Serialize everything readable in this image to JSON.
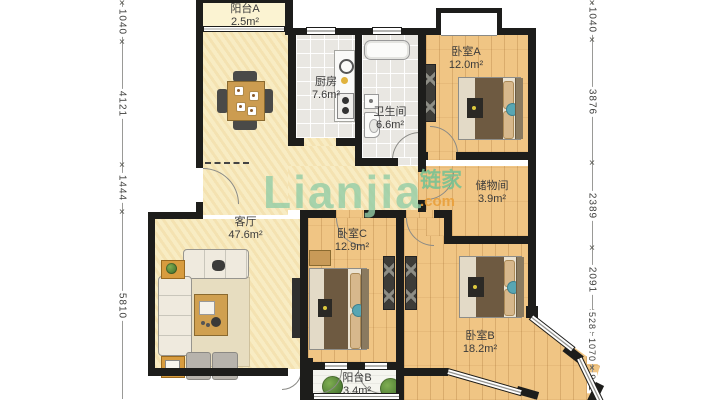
{
  "plan": {
    "rooms": [
      {
        "key": "balcony_a",
        "name": "阳台A",
        "area": "2.5m²"
      },
      {
        "key": "kitchen",
        "name": "厨房",
        "area": "7.6m²"
      },
      {
        "key": "bathroom",
        "name": "卫生间",
        "area": "6.6m²"
      },
      {
        "key": "bedroom_a",
        "name": "卧室A",
        "area": "12.0m²"
      },
      {
        "key": "storage",
        "name": "储物间",
        "area": "3.9m²"
      },
      {
        "key": "living",
        "name": "客厅",
        "area": "47.6m²"
      },
      {
        "key": "bedroom_c",
        "name": "卧室C",
        "area": "12.9m²"
      },
      {
        "key": "bedroom_b",
        "name": "卧室B",
        "area": "18.2m²"
      },
      {
        "key": "balcony_b",
        "name": "阳台B",
        "area": "3.4m²"
      }
    ],
    "dimensions": {
      "left": [
        "1040",
        "4121",
        "1444",
        "5810"
      ],
      "right": [
        "1040",
        "3876",
        "2389",
        "2091",
        "528",
        "1070",
        "911"
      ]
    },
    "dim_tick": "✕",
    "watermark": {
      "latin": "Lianjia",
      "cn": "链家",
      "tld": ".com"
    },
    "colors": {
      "wall": "#1d1d1b",
      "living_floor": "#f8ecc3",
      "wood_floor": "#f0c584",
      "tile_floor": "#e9e7e2",
      "balcony_a_floor": "#fbf3d2",
      "balcony_b_floor": "#f5f5ef",
      "watermark_green": "#92cda6",
      "watermark_orange": "#e9a03c"
    }
  }
}
